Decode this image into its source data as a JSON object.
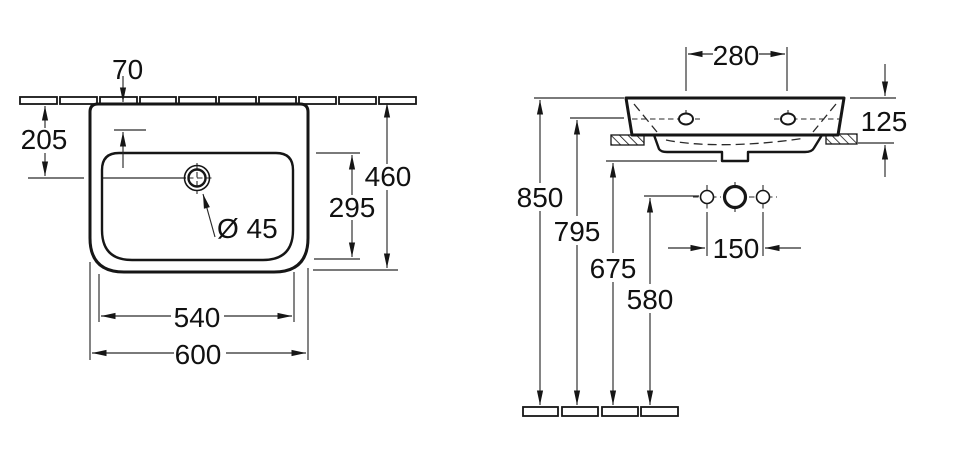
{
  "meta": {
    "title": "Wall-hung washbasin installation drawing",
    "background": "#ffffff",
    "line_color": "#161616"
  },
  "front_view": {
    "name": "front view",
    "dimensions": {
      "tap_hole_setback": "70",
      "top_to_tap_center": "205",
      "overall_height": "460",
      "bowl_height": "295",
      "tap_hole_diameter": "Ø 45",
      "bowl_width": "540",
      "overall_width": "600"
    }
  },
  "side_view": {
    "name": "side view",
    "dimensions": {
      "fixing_hole_spacing": "280",
      "apron_height": "125",
      "rim_height": "850",
      "fixing_hole_height": "795",
      "underside_height": "675",
      "supply_height": "580",
      "supply_spacing": "150"
    }
  }
}
